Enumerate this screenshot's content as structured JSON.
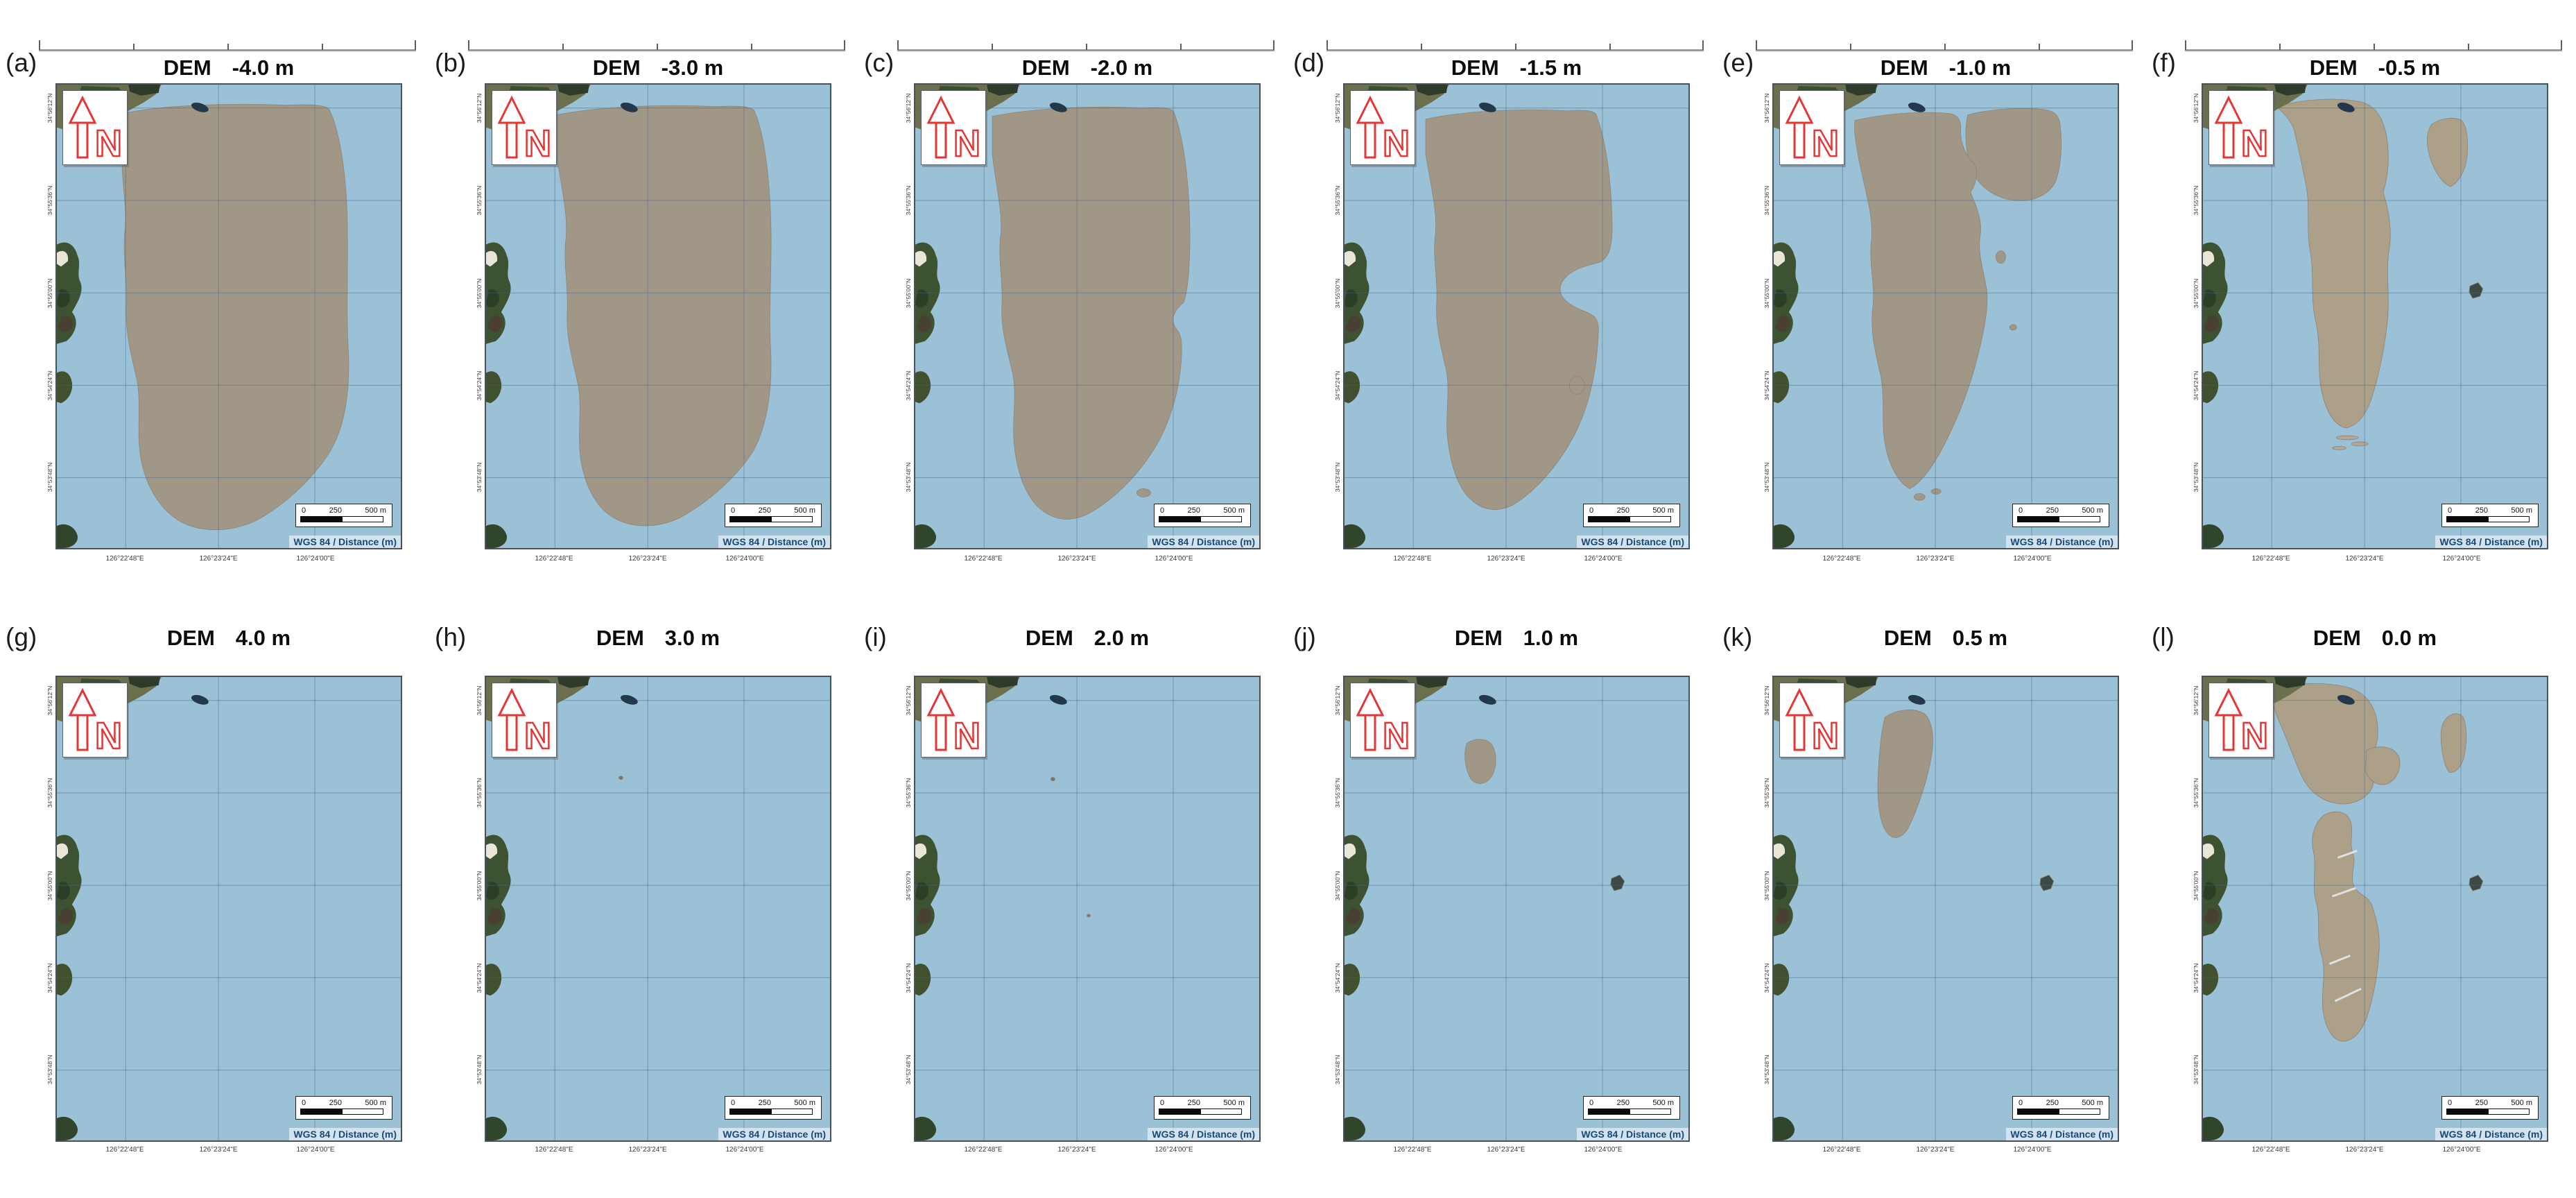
{
  "panels": [
    {
      "id": "(a)",
      "dem": "DEM",
      "value": "-4.0 m"
    },
    {
      "id": "(b)",
      "dem": "DEM",
      "value": "-3.0 m"
    },
    {
      "id": "(c)",
      "dem": "DEM",
      "value": "-2.0 m"
    },
    {
      "id": "(d)",
      "dem": "DEM",
      "value": "-1.5 m"
    },
    {
      "id": "(e)",
      "dem": "DEM",
      "value": "-1.0 m"
    },
    {
      "id": "(f)",
      "dem": "DEM",
      "value": "-0.5 m"
    },
    {
      "id": "(g)",
      "dem": "DEM",
      "value": "4.0 m"
    },
    {
      "id": "(h)",
      "dem": "DEM",
      "value": "3.0 m"
    },
    {
      "id": "(i)",
      "dem": "DEM",
      "value": "2.0 m"
    },
    {
      "id": "(j)",
      "dem": "DEM",
      "value": "1.0 m"
    },
    {
      "id": "(k)",
      "dem": "DEM",
      "value": "0.5 m"
    },
    {
      "id": "(l)",
      "dem": "DEM",
      "value": "0.0 m"
    }
  ],
  "map": {
    "north_label": "N",
    "crs_label": "WGS 84 / Distance (m)",
    "scalebar": {
      "tick0": "0",
      "tick1": "250",
      "tick2": "500 m"
    },
    "lon_labels": [
      "126°22'48\"E",
      "126°23'24\"E",
      "126°24'00\"E"
    ],
    "lat_labels": [
      "34°56'12\"N",
      "34°55'36\"N",
      "34°55'00\"N",
      "34°54'24\"N",
      "34°53'48\"N"
    ]
  },
  "colors": {
    "water": "#9bc1d7",
    "tidal_flat": "#a19787",
    "tidal_flat_light": "#aca089",
    "coast_green": "#3c5230",
    "grid_line": "#46678a",
    "north_arrow_red": "#e53535",
    "crs_text": "#17497c"
  }
}
